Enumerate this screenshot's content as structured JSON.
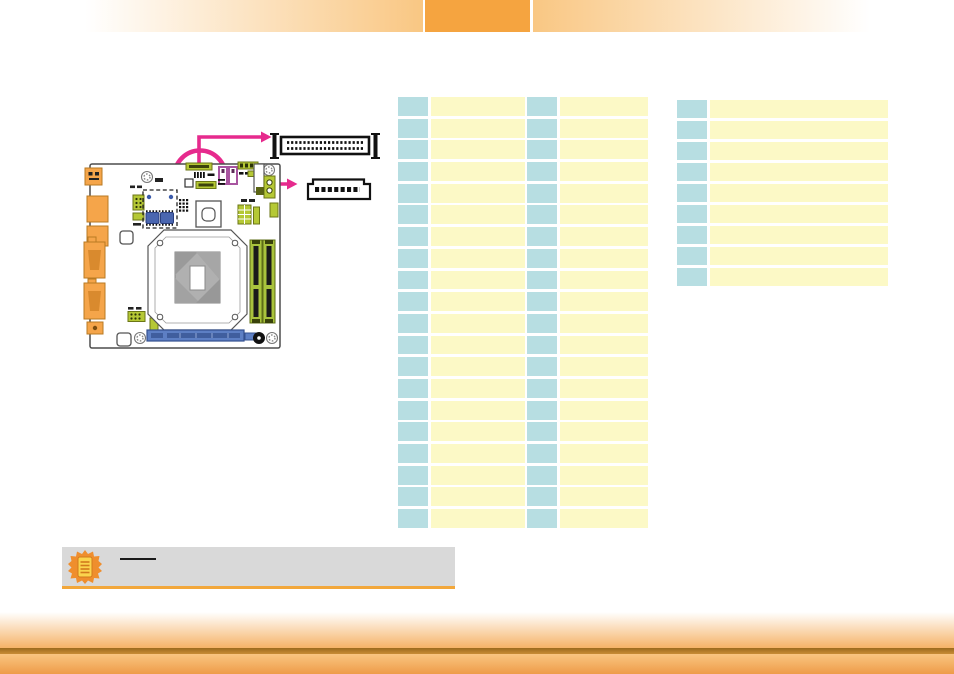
{
  "document": {
    "kind": "motherboard-manual-page",
    "note_text_visible": false,
    "table_text_visible": false
  },
  "header": {
    "tab_label": "",
    "tab_color": "#f5a440",
    "bar_gradient_color": "#f9c783"
  },
  "footer": {
    "band_color": "#c88c36",
    "strip_color": "#ee9c49"
  },
  "tables": {
    "left": {
      "rows": 20,
      "cell_text": "",
      "columns": [
        {
          "role": "pin-number",
          "color": "#b7dee2"
        },
        {
          "role": "description",
          "color": "#fcf9c6"
        },
        {
          "role": "pin-number",
          "color": "#b7dee2"
        },
        {
          "role": "description",
          "color": "#fcf9c6"
        }
      ]
    },
    "right": {
      "rows": 9,
      "cell_text": "",
      "columns": [
        {
          "role": "pin-number",
          "color": "#b7dee2"
        },
        {
          "role": "description",
          "color": "#fcf9c6"
        }
      ]
    }
  },
  "note": {
    "heading_text": "",
    "heading_redacted": true,
    "body_text": "",
    "background": "#d9d9d9",
    "underline_color": "#f2a73b",
    "icon": "note-burst-document-icon"
  },
  "diagram": {
    "description": "mini-itx-motherboard-top-view-with-connector-callouts",
    "highlight_color": "#e62a8d",
    "highlighted_connector_count": 2,
    "callouts": [
      {
        "name": "dual-row-box-header",
        "pin_rows": 2,
        "pins_per_row": 20
      },
      {
        "name": "single-row-pin-header",
        "pin_rows": 1,
        "pins_per_row": 8
      }
    ],
    "colors": {
      "lime_header": "#b5c835",
      "dimm_slot": "#a9c33d",
      "pcie_slot": "#5d7fc4",
      "msata_connector": "#4a66b0",
      "sata_port": "#a855a0",
      "rear_io_orange": "#f5a54a",
      "board_outline": "#4d4d4d"
    }
  }
}
